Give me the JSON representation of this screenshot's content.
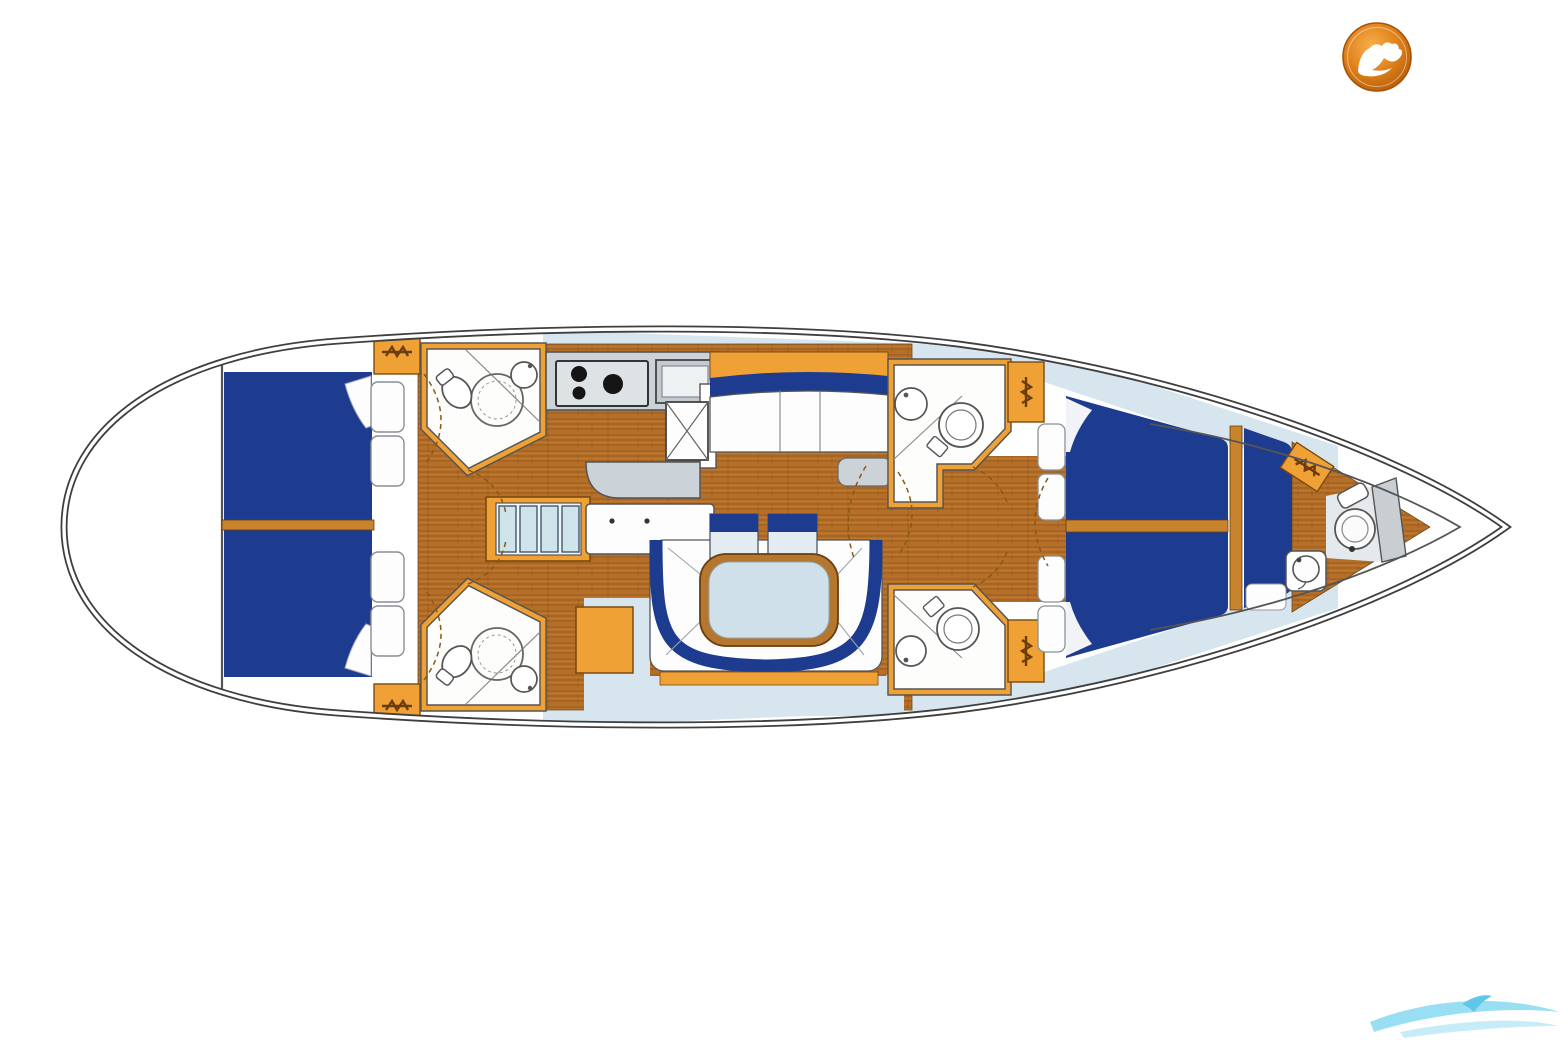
{
  "page": {
    "background": "#ffffff"
  },
  "logo": {
    "shape": "circular-badge",
    "glyph": "seagull-bird",
    "badge_color": "#dd7f18",
    "badge_edge": "#a85408",
    "glyph_color": "#ffffff"
  },
  "watermark": {
    "style": "wave-swoosh",
    "color": "#8edcf2",
    "color_light": "#c6ecf8"
  },
  "palette": {
    "hull_line": "#3f3f3f",
    "inner_line": "#555555",
    "bed_navy": "#1e3c8f",
    "joinery_orange": "#f0a136",
    "divider_tan": "#c8842c",
    "wood_trim": "#6b3c0d",
    "deck_blue": "#d7e6ee",
    "steps_blue": "#cfe3eb",
    "table_blue": "#cfe0ea",
    "counter_gray": "#ccd3d8",
    "fixture_outline": "#555555",
    "door_arc": "#8a5a12",
    "cushion_white": "#fdfdfd",
    "table_wood": "#b5772f",
    "seatback_body": "#e3ecf1"
  }
}
